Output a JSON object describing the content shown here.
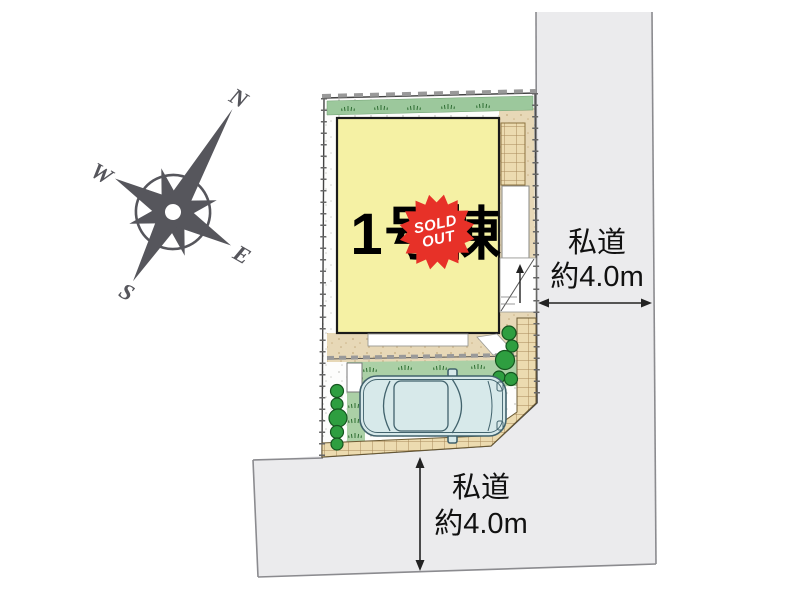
{
  "compass": {
    "north": "N",
    "east": "E",
    "south": "S",
    "west": "W"
  },
  "building": {
    "name": "1号棟",
    "status": {
      "line1": "SOLD",
      "line2": "OUT"
    }
  },
  "roads": {
    "east": {
      "type": "私道",
      "width": "約4.0m"
    },
    "south": {
      "type": "私道",
      "width": "約4.0m"
    }
  },
  "colors": {
    "road_fill": "#ebebed",
    "building_fill": "#f5f1a4",
    "lawn_green": "#abd0a6",
    "strip_green": "#9cc89c",
    "brick_tan": "#ecdbb0",
    "gravel_tan": "#e7d8b7",
    "badge_red": "#e73128",
    "compass_gray": "#56565c",
    "car_body": "#d7e9ea"
  }
}
